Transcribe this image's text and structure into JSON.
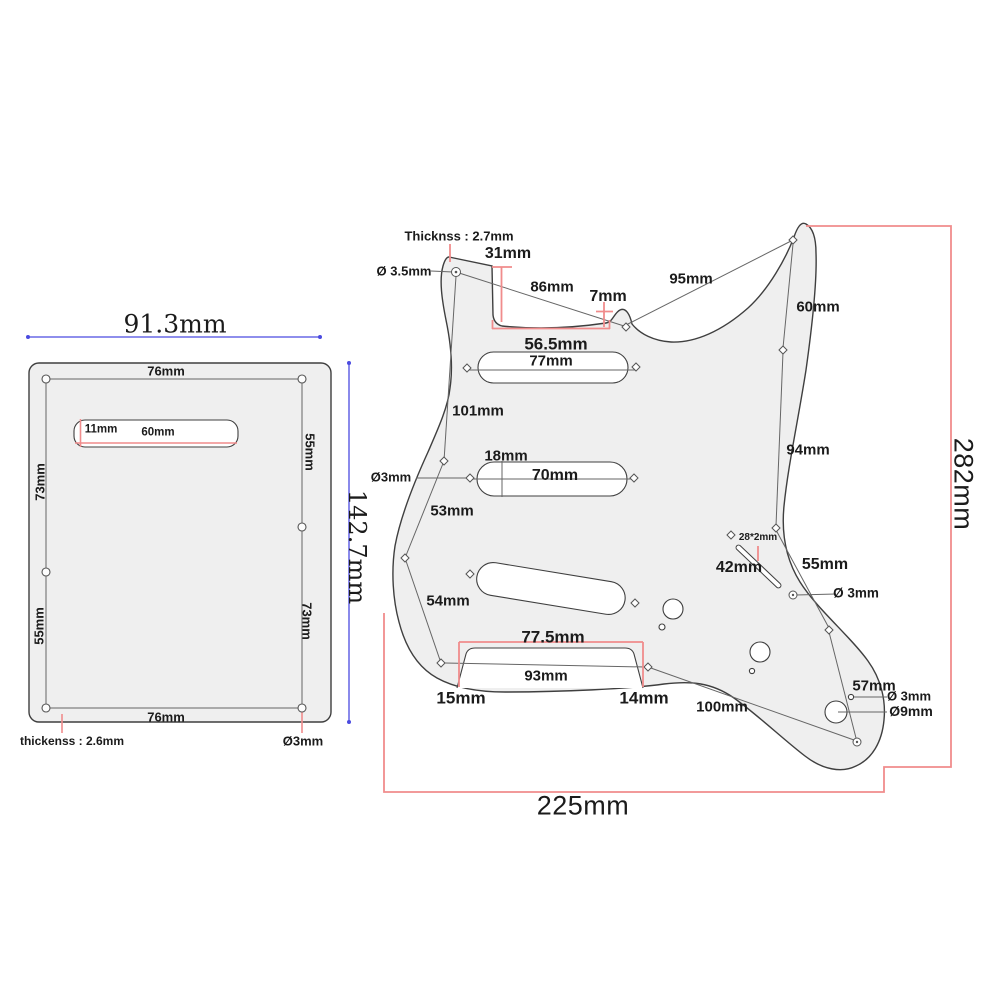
{
  "title": "pickguard-dimension-drawing",
  "colors": {
    "dimension_red": "#f08c8c",
    "dimension_blue": "#4b4be0",
    "outline": "#3f3f3f",
    "thin_line": "#666666",
    "plate_fill": "#efefef"
  },
  "backplate": {
    "width": "91.3mm",
    "height": "142.7mm",
    "top_edge": "76mm",
    "bottom_edge": "76mm",
    "left_upper": "73mm",
    "left_lower": "55mm",
    "right_upper": "55mm",
    "right_lower": "73mm",
    "slot_height": "11mm",
    "slot_width": "60mm",
    "thickness": "thickenss : 2.6mm",
    "screw_hole": "Ø3mm"
  },
  "pickguard": {
    "thickness": "Thicknss : 2.7mm",
    "top_hole": "Ø 3.5mm",
    "neck_pocket_depth": "31mm",
    "neck_diagonal": "86mm",
    "step": "7mm",
    "horn_span": "95mm",
    "right_upper": "60mm",
    "neck_pocket_width": "56.5mm",
    "neck_pickup_width": "77mm",
    "left_upper": "101mm",
    "mid_pickup_height": "18mm",
    "mid_pickup_width": "70mm",
    "left_hole": "Ø3mm",
    "left_mid": "53mm",
    "left_lower": "54mm",
    "switch_slot": "28*2mm",
    "switch_length": "42mm",
    "right_mid": "55mm",
    "right_hole": "Ø 3mm",
    "right_side": "94mm",
    "bridge_outer_width": "77.5mm",
    "bridge_inner_width": "93mm",
    "bridge_left_depth": "15mm",
    "bridge_right_depth": "14mm",
    "bottom_span": "100mm",
    "jack_span": "57mm",
    "jack_screw_hole": "Ø 3mm",
    "jack_hole": "Ø9mm",
    "total_height": "282mm",
    "total_width": "225mm"
  }
}
